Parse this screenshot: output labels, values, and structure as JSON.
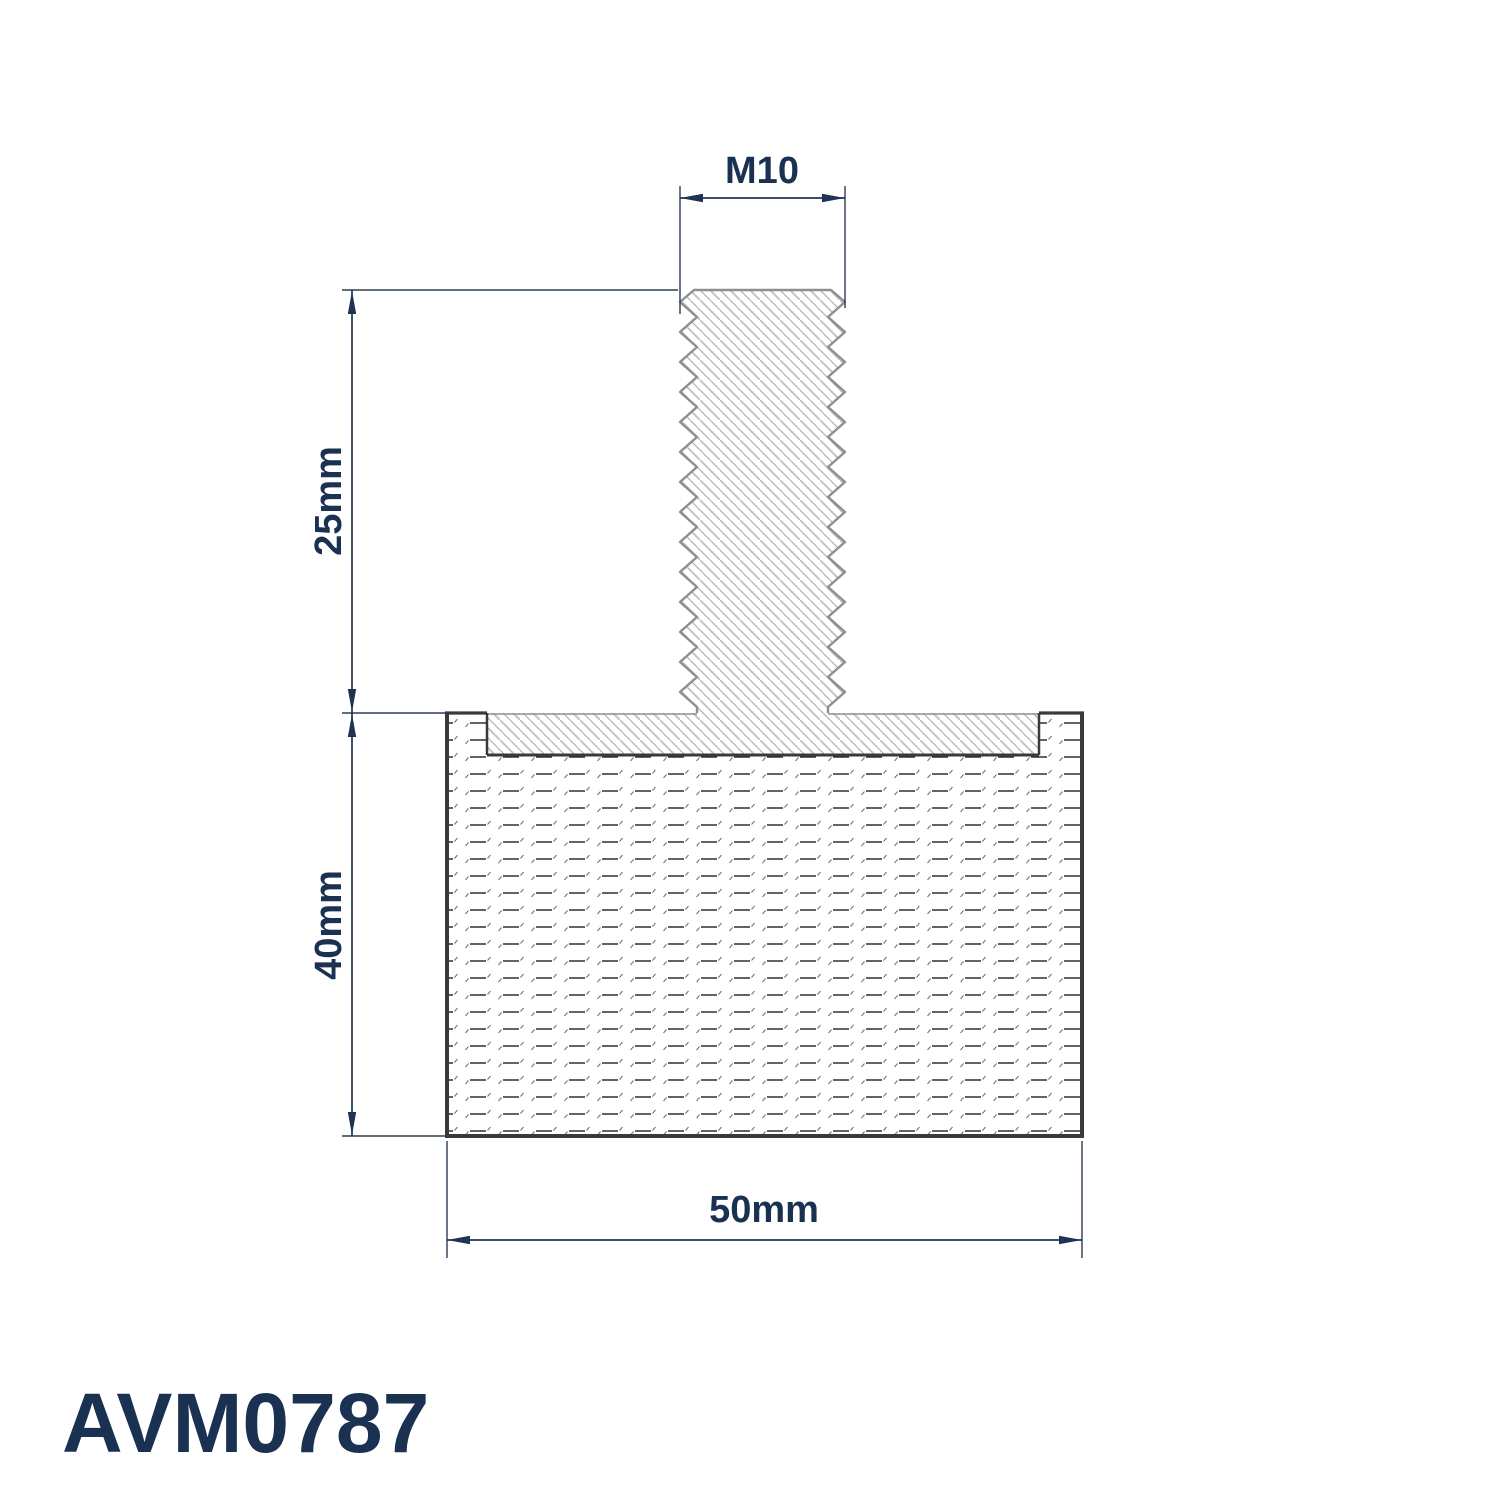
{
  "drawing": {
    "part_number": "AVM0787",
    "labels": {
      "thread_size": "M10",
      "stud_length": "25mm",
      "body_height": "40mm",
      "body_diameter": "50mm"
    },
    "colors": {
      "label_navy": "#1a3152",
      "dimension_line": "#22344e",
      "outline_dark": "#3a3a3a",
      "thread_outline_gray": "#8f8f8f",
      "hatch_gray": "#c3c3c3"
    }
  }
}
